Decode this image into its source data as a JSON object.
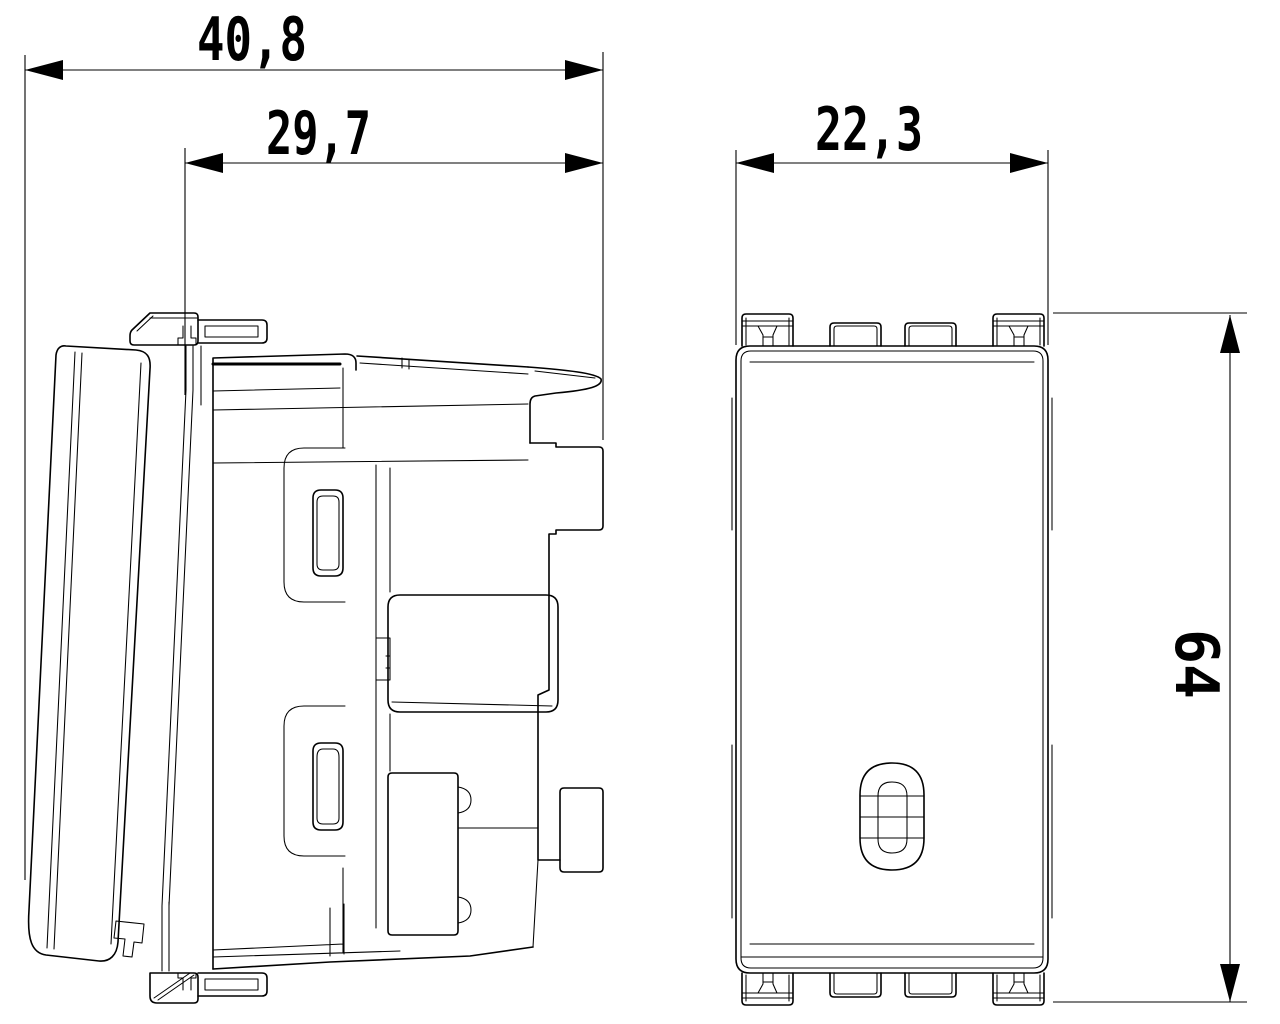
{
  "dimensions": {
    "overall_depth": "40,8",
    "body_depth": "29,7",
    "front_width": "22,3",
    "front_height": "64"
  },
  "style": {
    "line_color": "#000000",
    "background": "#ffffff"
  }
}
